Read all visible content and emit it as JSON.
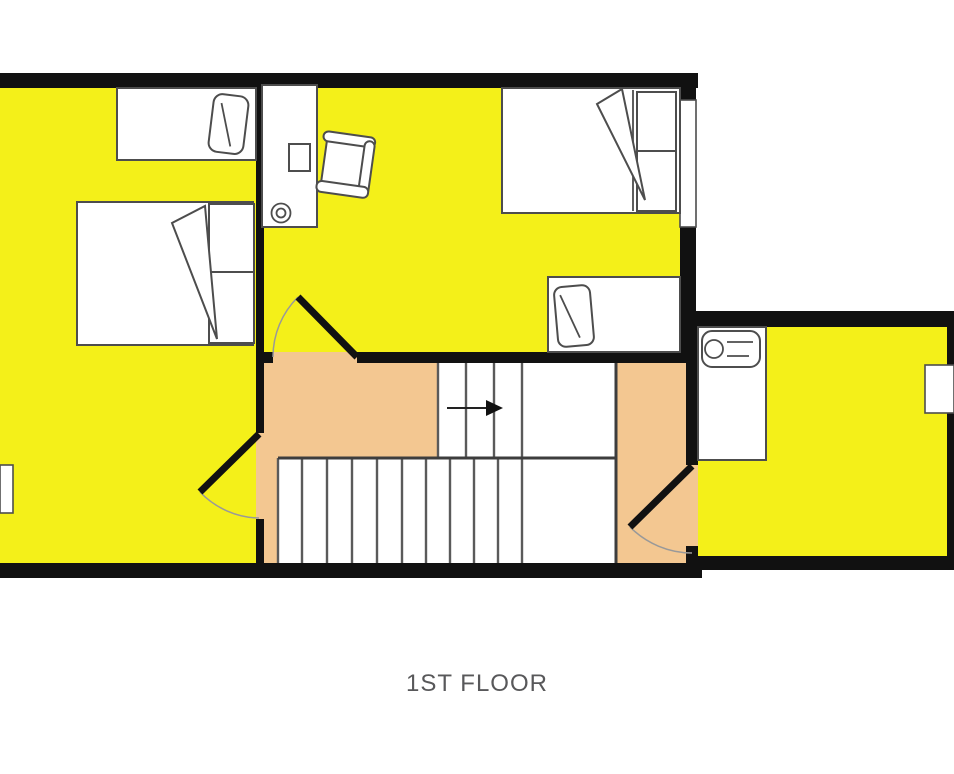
{
  "caption": {
    "text": "1ST FLOOR"
  },
  "colors": {
    "page-bg": "#ffffff",
    "room-fill": "#F4F019",
    "circulation-fill": "#F3C791",
    "wall": "#111111",
    "furniture-outline": "#4d4d4d",
    "stair-line": "#5a5a5a",
    "divider-line": "#3d3d3d",
    "door-arc": "#999999",
    "caption-text": "#58585a"
  },
  "plan": {
    "floor_label": "1ST FLOOR",
    "rooms": [
      "bedroom-left",
      "bedroom-middle",
      "bedroom-right",
      "landing",
      "hall"
    ],
    "stairs": {
      "up_arrow_direction": "right",
      "upper_treads": 3,
      "lower_treads": 10
    }
  }
}
